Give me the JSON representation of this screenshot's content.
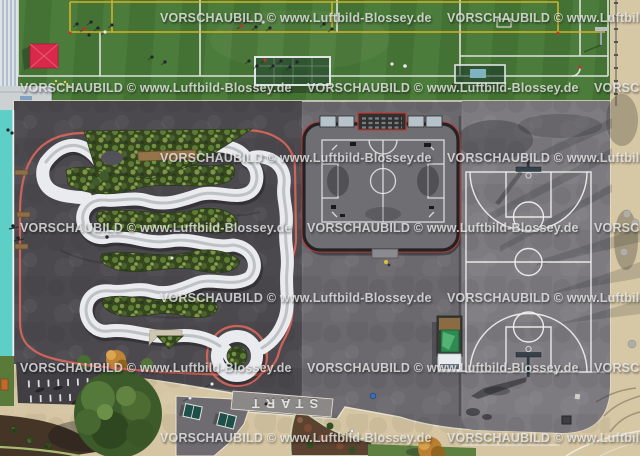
{
  "meta": {
    "type": "aerial-photograph",
    "subject": "Aerial view of a sports park: artificial turf soccer field, bicycle pump track, multi-sport cage court, streetball court, footpaths",
    "width_px": 640,
    "height_px": 456
  },
  "watermark": {
    "text": "VORSCHAUBILD © www.Luftbild-Blossey.de",
    "color": "#efefef"
  },
  "ground_labels": {
    "start": "START"
  },
  "palette": {
    "turf_green": "#4c7c3b",
    "turf_stripe": "#447234",
    "line_white": "#e9ece8",
    "line_yellow": "#d9b425",
    "asphalt_dark": "#4b494e",
    "asphalt_mid": "#6b696e",
    "asphalt_light": "#7d7b80",
    "track_surface": "#e9ebee",
    "track_edge_red": "#e4695c",
    "lane_teal": "#5ecfc6",
    "path_beige": "#d5c5a2",
    "cage_red": "#c23a30",
    "cage_frame": "#232327",
    "seat_blue": "#b7c3ca",
    "tent_red": "#d8294a",
    "truck_green": "#2f8a52",
    "foliage_dark": "#36471f",
    "watermark_color": "#efefef",
    "start_text": "#e9e7e1"
  }
}
